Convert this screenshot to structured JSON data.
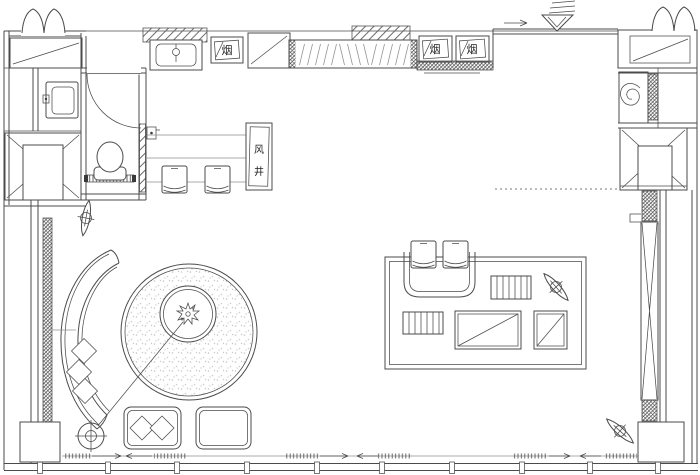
{
  "document": {
    "type": "architectural floor plan drawing",
    "language": "zh"
  },
  "labels": {
    "smoke": "烟",
    "wind_shaft": "风井",
    "wind_char": "风",
    "well_char": "井"
  },
  "colors": {
    "background": "#ffffff",
    "line": "#4b4b4b",
    "line_light": "#8f8f8f",
    "hatch": "#555555",
    "stipple_fill": "#c4c4c4",
    "text": "#1e1e1e"
  }
}
